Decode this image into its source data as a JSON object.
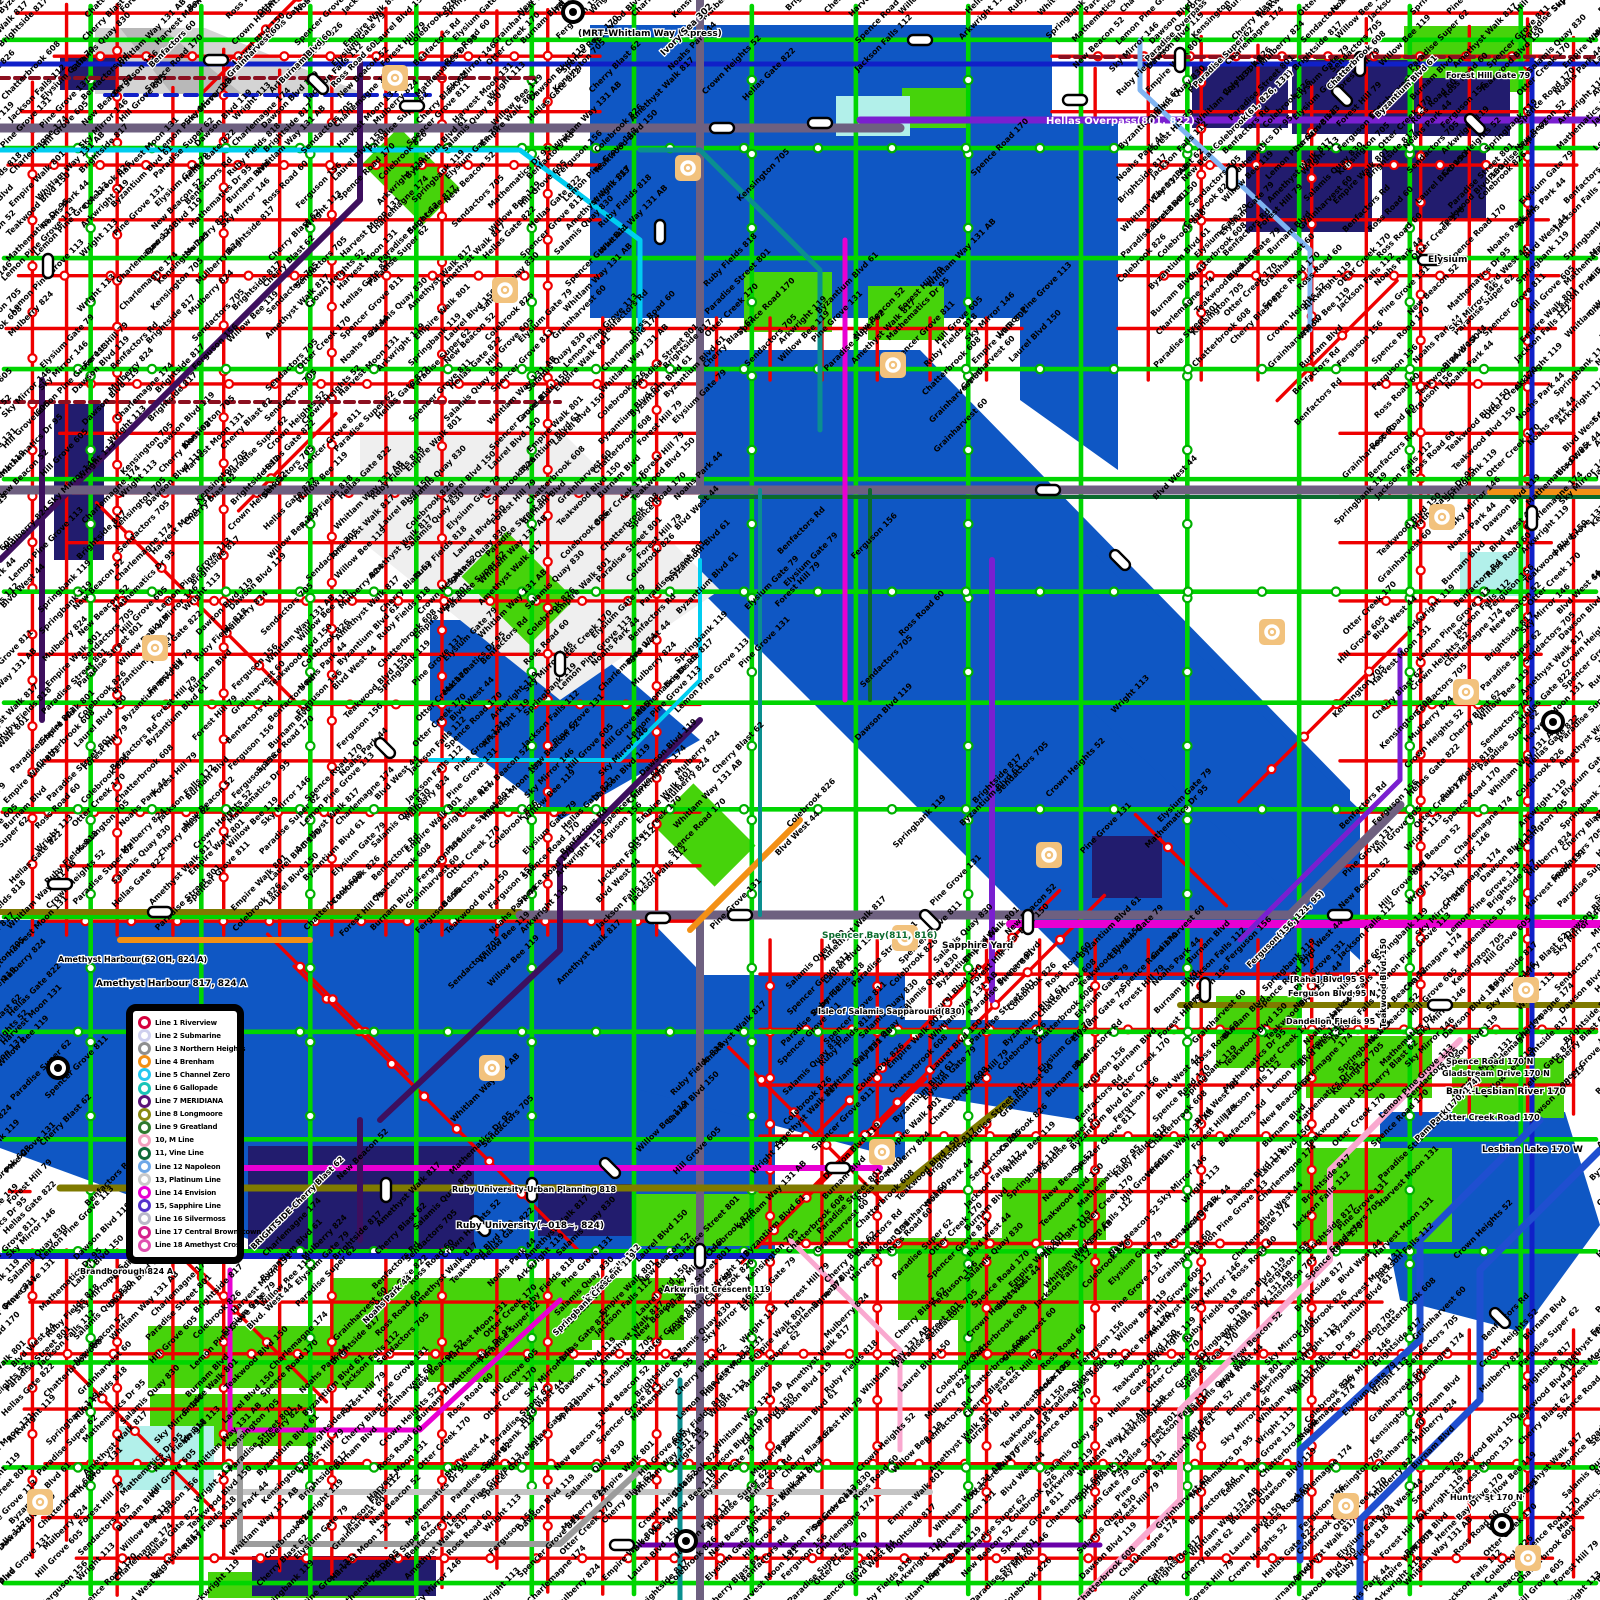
{
  "map": {
    "name": "metropolitan-transit-network-map",
    "sea_label": "Ivory Sea 302"
  },
  "colors": {
    "water": "#0f57c4",
    "park": "#46d30b",
    "pale_cyan": "#b2f0ea",
    "building": "#221c6e",
    "mountain": "#d4d4d4",
    "grid_red": "#ee0000",
    "route_green": "#00d500",
    "slate": "#6e6080",
    "olive": "#7f7a00",
    "navy": "#1020c8",
    "royal": "#1f4fd0",
    "cyan": "#00cdf0",
    "light_blue": "#7fb4f2",
    "teal": "#0a8f8f",
    "dark_green": "#0a6b2d",
    "purple": "#7a1fd0",
    "dark_purple": "#3d0f5e",
    "violet": "#6a00a8",
    "magenta": "#e800d2",
    "pink": "#f9a8cf",
    "dark_red": "#8c1020",
    "orange": "#f39015",
    "silver": "#c4c4c4",
    "gray": "#9c9c9c",
    "yard_tan": "#f2c27d"
  },
  "legend": {
    "items": [
      {
        "label": "Line 1 Riverview",
        "color": "#d6003c"
      },
      {
        "label": "Line 2 Submarine",
        "color": "#cfd0ee"
      },
      {
        "label": "Line 3 Northern Heights",
        "color": "#8f8f8f"
      },
      {
        "label": "Line 4 Brenham",
        "color": "#f39015"
      },
      {
        "label": "Line 5 Channel Zero",
        "color": "#25c8f0"
      },
      {
        "label": "Line 6 Gallopade",
        "color": "#19c5b8"
      },
      {
        "label": "Line 7 MERIDIANA",
        "color": "#5a1378"
      },
      {
        "label": "Line 8 Longmoore",
        "color": "#8a8a12"
      },
      {
        "label": "Line 9 Greatland",
        "color": "#2f7a2f"
      },
      {
        "label": "10, M Line",
        "color": "#f4a0c0"
      },
      {
        "label": "11, Vine Line",
        "color": "#0f6b3a"
      },
      {
        "label": "Line 12 Napoleon",
        "color": "#6fa8e8"
      },
      {
        "label": "13, Platinum Line",
        "color": "#c9c9c9"
      },
      {
        "label": "Line 14 Envision",
        "color": "#e800d2"
      },
      {
        "label": "15, Sapphire Line",
        "color": "#5533cc"
      },
      {
        "label": "Line 16 Silvermoss",
        "color": "#b9b9c9"
      },
      {
        "label": "Line 17 Central Brownstown",
        "color": "#d61f8d"
      },
      {
        "label": "Line 18 Amethyst Cross",
        "color": "#e04fb0"
      }
    ]
  },
  "notable_labels": [
    {
      "text": "(MRT–Whitlam Way Express)",
      "x": 578,
      "y": 36,
      "size": 9,
      "color": "#000000",
      "rotate": 0
    },
    {
      "text": "Ivory Sea 302",
      "x": 664,
      "y": 56,
      "size": 9,
      "color": "#000000",
      "rotate": -45
    },
    {
      "text": "Hellas Overpass(801, 822)",
      "x": 1046,
      "y": 124,
      "size": 10,
      "color": "#ffffff",
      "rotate": 0
    },
    {
      "text": "Paradise Overpass 801",
      "x": 1148,
      "y": 62,
      "size": 8,
      "color": "#000000",
      "rotate": -45
    },
    {
      "text": "Paradise Super 62",
      "x": 1196,
      "y": 88,
      "size": 8,
      "color": "#000000",
      "rotate": -45
    },
    {
      "text": "Colebrook(61, 826, 131)",
      "x": 1216,
      "y": 150,
      "size": 8,
      "color": "#000000",
      "rotate": -45
    },
    {
      "text": "Byzantium Blvd 61",
      "x": 1378,
      "y": 118,
      "size": 8,
      "color": "#000000",
      "rotate": -45
    },
    {
      "text": "Chatterbrook 608",
      "x": 1330,
      "y": 90,
      "size": 8,
      "color": "#000000",
      "rotate": -45
    },
    {
      "text": "Elysium",
      "x": 1428,
      "y": 262,
      "size": 9,
      "color": "#000000",
      "rotate": 0
    },
    {
      "text": "Forest Hill Gate 79",
      "x": 1446,
      "y": 78,
      "size": 8,
      "color": "#000000",
      "rotate": 0
    },
    {
      "text": "Sky Mirror 146",
      "x": 1452,
      "y": 332,
      "size": 8,
      "color": "#000000",
      "rotate": -45
    },
    {
      "text": "Benfactors 60",
      "x": 152,
      "y": 68,
      "size": 8,
      "color": "#000000",
      "rotate": -45
    },
    {
      "text": "Grainharvest 60",
      "x": 230,
      "y": 78,
      "size": 8,
      "color": "#000000",
      "rotate": -45
    },
    {
      "text": "Burnam Blvd 60",
      "x": 282,
      "y": 84,
      "size": 8,
      "color": "#000000",
      "rotate": -45
    },
    {
      "text": "Ross Road 60",
      "x": 334,
      "y": 88,
      "size": 8,
      "color": "#000000",
      "rotate": -45
    },
    {
      "text": "Spencer Bay(811, 816)",
      "x": 822,
      "y": 938,
      "size": 9,
      "color": "#0a6b2d",
      "rotate": 0
    },
    {
      "text": "Sapphire Yard",
      "x": 942,
      "y": 948,
      "size": 9,
      "color": "#000000",
      "rotate": 0
    },
    {
      "text": "Isle of Salamis Sapparound(830)",
      "x": 818,
      "y": 1014,
      "size": 8,
      "color": "#000000",
      "rotate": 0
    },
    {
      "text": "Amethyst Harbour(62 OH, 824 A)",
      "x": 58,
      "y": 962,
      "size": 8,
      "color": "#000000",
      "rotate": 0
    },
    {
      "text": "Amethyst Harbour 817, 824 A",
      "x": 96,
      "y": 986,
      "size": 9,
      "color": "#000000",
      "rotate": 0
    },
    {
      "text": "Brandborough 824 A",
      "x": 80,
      "y": 1274,
      "size": 8,
      "color": "#000000",
      "rotate": 0
    },
    {
      "text": "Ruby University-Urban Planning 818",
      "x": 452,
      "y": 1192,
      "size": 8,
      "color": "#000000",
      "rotate": 0
    },
    {
      "text": "Ruby University(~018~, 824)",
      "x": 456,
      "y": 1228,
      "size": 9,
      "color": "#000000",
      "rotate": 0
    },
    {
      "text": "[Raha] Blvd 95 S",
      "x": 1290,
      "y": 982,
      "size": 8,
      "color": "#000000",
      "rotate": 0
    },
    {
      "text": "Ferguson Blvd 95 N",
      "x": 1288,
      "y": 996,
      "size": 8,
      "color": "#000000",
      "rotate": 0
    },
    {
      "text": "Dandelion Fields 95",
      "x": 1286,
      "y": 1024,
      "size": 8,
      "color": "#000000",
      "rotate": 0
    },
    {
      "text": "Ferguson(156, 121, 95)",
      "x": 1250,
      "y": 968,
      "size": 8,
      "color": "#000000",
      "rotate": -45
    },
    {
      "text": "Teakwood Blvd. 150",
      "x": 1386,
      "y": 1028,
      "size": 8,
      "color": "#000000",
      "rotate": -90
    },
    {
      "text": "Spence Road 170 N",
      "x": 1446,
      "y": 1064,
      "size": 8,
      "color": "#000000",
      "rotate": 0
    },
    {
      "text": "Gladstream Drive 170 N",
      "x": 1442,
      "y": 1076,
      "size": 8,
      "color": "#000000",
      "rotate": 0
    },
    {
      "text": "Bank-Lesbian River 170",
      "x": 1446,
      "y": 1094,
      "size": 9,
      "color": "#000000",
      "rotate": 0
    },
    {
      "text": "Otter Creek Road 170",
      "x": 1442,
      "y": 1120,
      "size": 8,
      "color": "#000000",
      "rotate": 0
    },
    {
      "text": "Lesbian Lake 170 W",
      "x": 1482,
      "y": 1152,
      "size": 9,
      "color": "#000000",
      "rotate": 0
    },
    {
      "text": "Pam Park(170, 174)",
      "x": 1418,
      "y": 1142,
      "size": 8,
      "color": "#000000",
      "rotate": -45
    },
    {
      "text": "Hunter St 170 N",
      "x": 1450,
      "y": 1500,
      "size": 8,
      "color": "#000000",
      "rotate": 0
    },
    {
      "text": "Herne Bay Drive 170",
      "x": 1438,
      "y": 1542,
      "size": 8,
      "color": "#000000",
      "rotate": -45
    },
    {
      "text": "Noahs Park 44",
      "x": 366,
      "y": 1324,
      "size": 8,
      "color": "#000000",
      "rotate": -45
    },
    {
      "text": "Blvd. West 44",
      "x": 250,
      "y": 1330,
      "size": 8,
      "color": "#000000",
      "rotate": -45
    },
    {
      "text": "Arkwright Crescent 119",
      "x": 664,
      "y": 1292,
      "size": 8,
      "color": "#000000",
      "rotate": 0
    },
    {
      "text": "Jackson Falls 112",
      "x": 586,
      "y": 1302,
      "size": 8,
      "color": "#000000",
      "rotate": -45
    },
    {
      "text": "Springbank Crescent 119",
      "x": 556,
      "y": 1336,
      "size": 8,
      "color": "#000000",
      "rotate": -45
    },
    {
      "text": "BRIGHTSIDE-Cherry Blast 62",
      "x": 254,
      "y": 1250,
      "size": 8,
      "color": "#000000",
      "rotate": -45
    }
  ],
  "hatch_labels": [
    "Paradise Street 801",
    "Colebrook 826",
    "Byzantium Blvd 61",
    "Chatterbrook 608",
    "Elysium Gate 79",
    "Forest Hill 79",
    "Grainharvest 60",
    "Benfactors Rd",
    "Burnam Blvd",
    "Ross Road 60",
    "Ferguson 156",
    "Teakwood Blvd 150",
    "Otter Creek 170",
    "Spence Road 170",
    "Noahs Park 44",
    "Blvd West 44",
    "Arkwright 119",
    "Jackson Falls 112",
    "Springbank 119",
    "Pine Grove 131",
    "New Beacon 52",
    "Mathematics Dr 95",
    "Hill Grove 605",
    "Sky Mirror 146",
    "Lemon Pine Grove 113",
    "Wright 113",
    "Dawson Blvd 119",
    "Charlemagne 174",
    "Kensington 705",
    "Mulberry 824",
    "Brightside 817",
    "Cherry Blast 62",
    "Sendactors 705",
    "Harvest Moon 131",
    "Crown Heights 52",
    "Willow Bee 119",
    "Paradise Super 62",
    "Hellas Gate 822",
    "Amethyst Walk 817",
    "Spencer Grove 811",
    "Ruby Fields 818",
    "Salamis Quay 830",
    "Empire Walk 801",
    "Whitlam Way 131 AB",
    "Laurel Blvd 150"
  ],
  "icon_names": [
    "roundel-icon",
    "yard-icon",
    "interchange-capsule",
    "station-marker"
  ]
}
